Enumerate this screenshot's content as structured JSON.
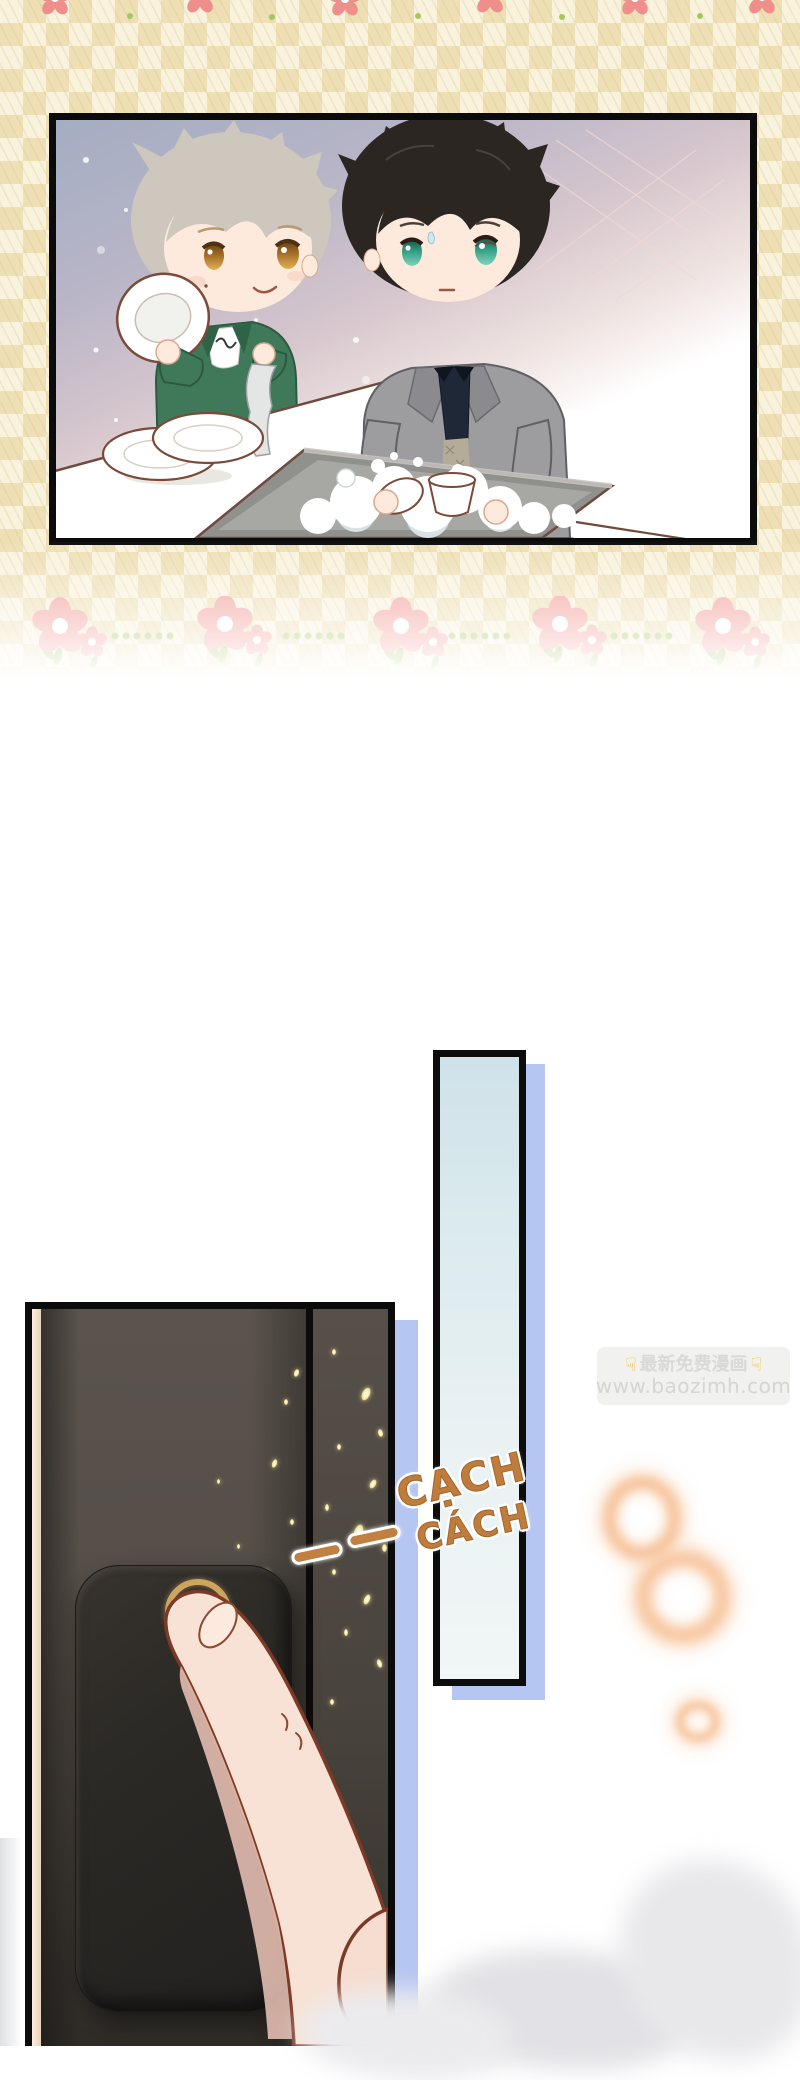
{
  "sfx": {
    "word1": "CẠCH",
    "word2": "CÁCH",
    "color": "#bf7c3c"
  },
  "watermark": {
    "hand_icon": "☟",
    "title": "最新免费漫画",
    "url": "www.baozimh.com"
  },
  "colors": {
    "plaid_base": "#f9f2dc",
    "plaid_check": "#eedfb4",
    "panel_border": "#0b0b0b",
    "flower_pink": "#f2a09c",
    "leaf_green": "#a5c760",
    "drop_shadow_blue": "#b6c6f2",
    "blue_panel_fill": "#cfe2e9",
    "door_dark": "#413c36",
    "sparkle_gold": "#ead98f",
    "bell_ring_gold": "#cfa55e",
    "skin": "#f8e2d5",
    "glow_orange": "#f7c49c",
    "jacket_green": "#40795a",
    "blazer_gray": "#9d9da0"
  }
}
